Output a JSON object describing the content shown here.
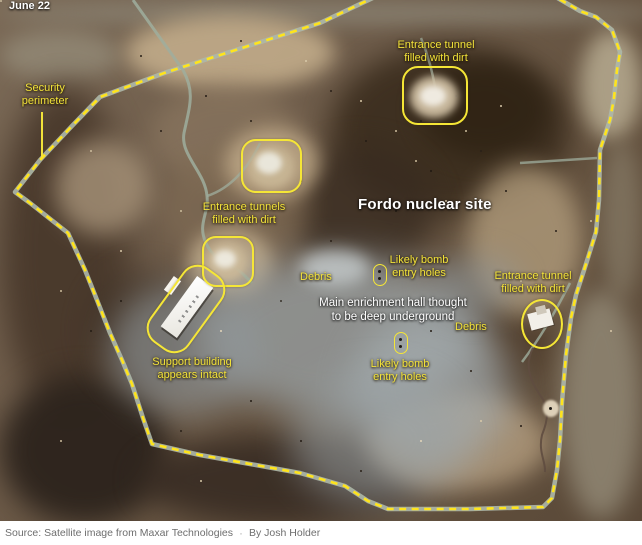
{
  "header": {
    "date_label": "June 22"
  },
  "map": {
    "title": "Fordo nuclear site",
    "labels": {
      "security_perimeter": {
        "lines": [
          "Security",
          "perimeter"
        ]
      },
      "tunnel_top": {
        "lines": [
          "Entrance tunnel",
          "filled with dirt"
        ]
      },
      "tunnels_mid": {
        "lines": [
          "Entrance tunnels",
          "filled with dirt"
        ]
      },
      "tunnel_right": {
        "lines": [
          "Entrance tunnel",
          "filled with dirt"
        ]
      },
      "bomb_holes_upper": {
        "lines": [
          "Likely bomb",
          "entry holes"
        ]
      },
      "bomb_holes_lower": {
        "lines": [
          "Likely bomb",
          "entry holes"
        ]
      },
      "support_building": {
        "lines": [
          "Support building",
          "appears intact"
        ]
      },
      "enrichment_hall": {
        "lines": [
          "Main enrichment hall thought",
          "to be deep underground"
        ]
      },
      "debris_left": "Debris",
      "debris_right": "Debris"
    },
    "colors": {
      "annotation_yellow": "#f2e23a",
      "dash_yellow": "#ffe41c",
      "label_white": "#ffffff"
    }
  },
  "footer": {
    "source": "Source: Satellite image from Maxar Technologies",
    "separator": "·",
    "byline": "By Josh Holder"
  }
}
